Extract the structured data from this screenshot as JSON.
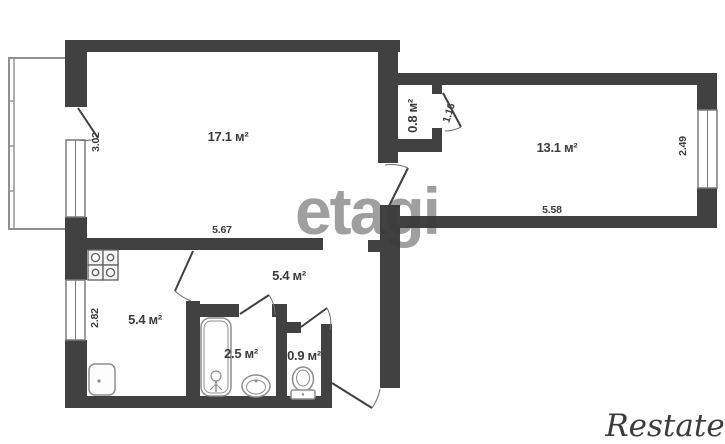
{
  "plan": {
    "living_room": {
      "area": "17.1 м²",
      "width": "5.67",
      "depth": "3.02"
    },
    "bedroom": {
      "area": "13.1 м²",
      "width": "5.58",
      "depth": "2.49"
    },
    "closet": {
      "area": "0.8 м²",
      "door_width": "1.16"
    },
    "hallway": {
      "area": "5.4 м²"
    },
    "kitchen": {
      "area": "5.4 м²",
      "depth": "2.82"
    },
    "bathroom": {
      "area": "2.5 м²"
    },
    "toilet": {
      "area": "0.9 м²"
    }
  },
  "watermarks": {
    "center": "etagi",
    "corner": "Restate"
  },
  "colors": {
    "wall": "#414141",
    "label": "#3c3c3c",
    "fixture": "#8e8e8e",
    "watermark_corner": "#c9c9c9"
  }
}
